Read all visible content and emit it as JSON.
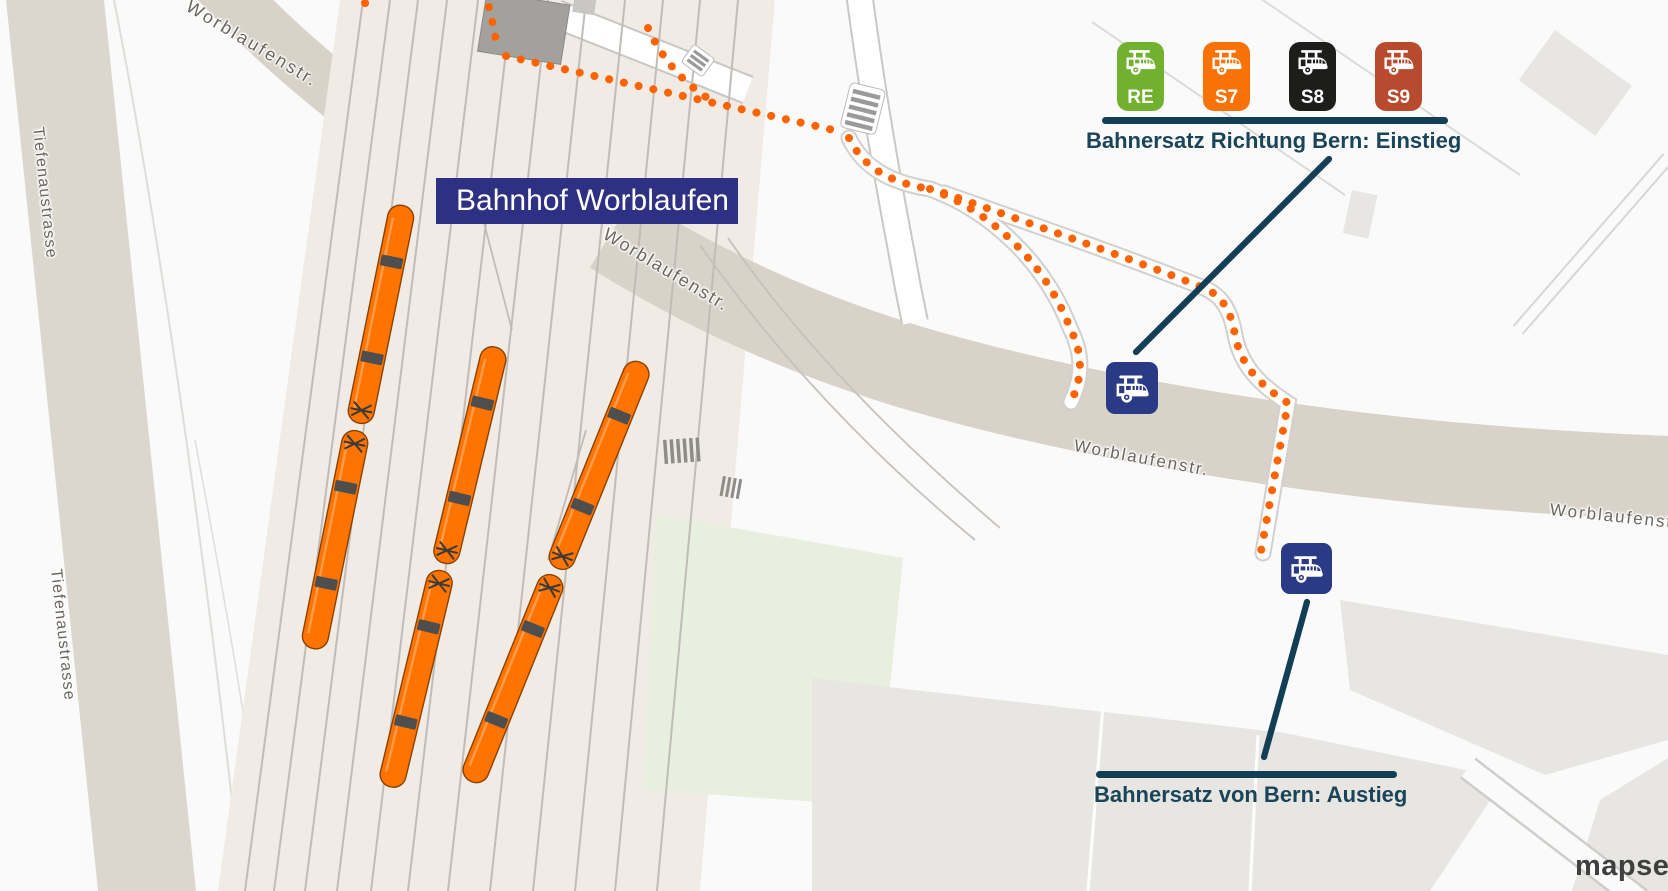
{
  "station": {
    "label": "Bahnhof Worblaufen"
  },
  "streets": {
    "worblaufenstrasse": "Worblaufenstr.",
    "tiefenaustrasse": "Tiefenaustrasse"
  },
  "annotations": {
    "einstieg": {
      "title": "Bahnersatz Richtung Bern: Einstieg"
    },
    "austieg": {
      "title": "Bahnersatz von Bern: Austieg"
    }
  },
  "legend_badges": [
    {
      "label": "RE",
      "color": "#72b02f"
    },
    {
      "label": "S7",
      "color": "#f97208"
    },
    {
      "label": "S8",
      "color": "#1d1d1b"
    },
    {
      "label": "S9",
      "color": "#b84b2e"
    }
  ],
  "icons": {
    "bus_stop": "trolleybus-stop-icon",
    "badge_glyph": "trolleybus-icon"
  },
  "logo": {
    "text": "mapset"
  },
  "colors": {
    "route_dots_orange": "#ff6300",
    "train_orange": "#ff7300",
    "station_navy": "#2e3183",
    "bus_icon_navy": "#2b3a85",
    "annotation_teal": "#123f54",
    "road_beige": "#d8d2c8",
    "rail_bed": "#f1ebe6"
  }
}
